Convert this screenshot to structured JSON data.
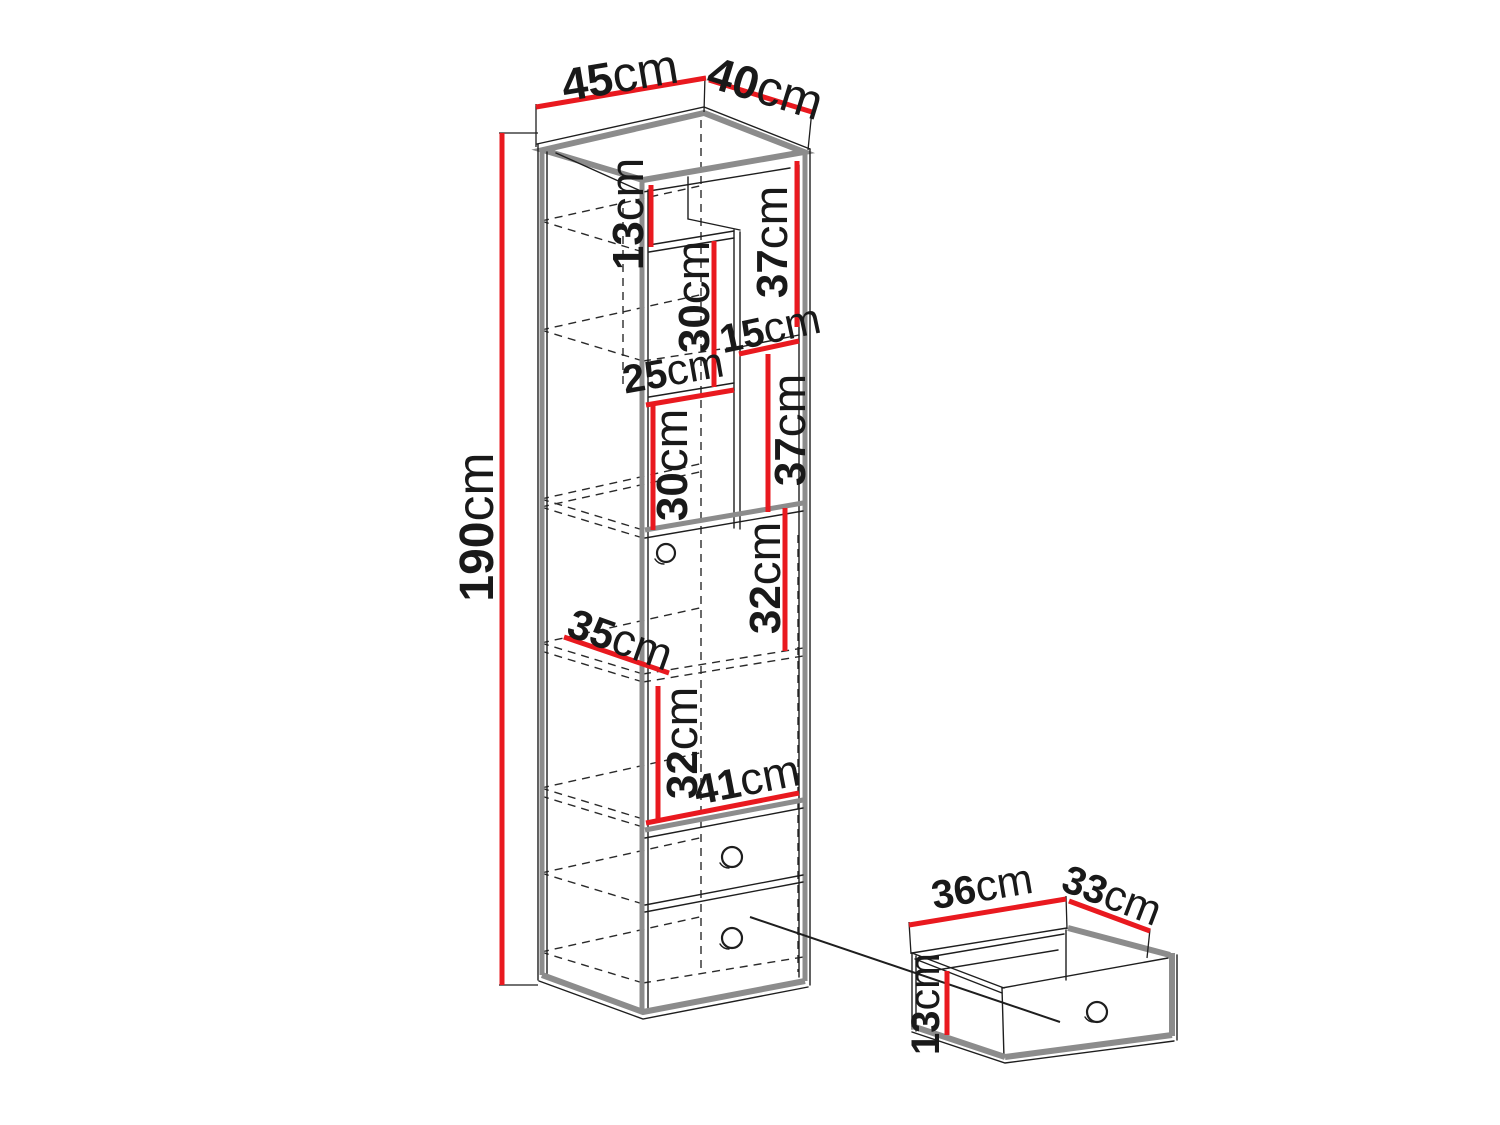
{
  "colors": {
    "dimension_red": "#e9191f",
    "line_black": "#1e1e1e",
    "edge_gray": "#8c8c8c",
    "background": "#ffffff"
  },
  "cabinet": {
    "top_width": {
      "num": "45",
      "unit": "cm"
    },
    "top_depth": {
      "num": "40",
      "unit": "cm"
    },
    "height": {
      "num": "190",
      "unit": "cm"
    },
    "sections": {
      "top_gap": {
        "num": "13",
        "unit": "cm"
      },
      "right_upper": {
        "num": "37",
        "unit": "cm"
      },
      "niche_upper": {
        "num": "30",
        "unit": "cm"
      },
      "niche_width": {
        "num": "15",
        "unit": "cm"
      },
      "left_width": {
        "num": "25",
        "unit": "cm"
      },
      "right_lower": {
        "num": "37",
        "unit": "cm"
      },
      "niche_lower": {
        "num": "30",
        "unit": "cm"
      },
      "door_upper": {
        "num": "32",
        "unit": "cm"
      },
      "inner_depth": {
        "num": "35",
        "unit": "cm"
      },
      "door_lower": {
        "num": "32",
        "unit": "cm"
      },
      "inner_width": {
        "num": "41",
        "unit": "cm"
      }
    }
  },
  "drawer": {
    "width": {
      "num": "36",
      "unit": "cm"
    },
    "depth": {
      "num": "33",
      "unit": "cm"
    },
    "height": {
      "num": "13",
      "unit": "cm"
    }
  }
}
